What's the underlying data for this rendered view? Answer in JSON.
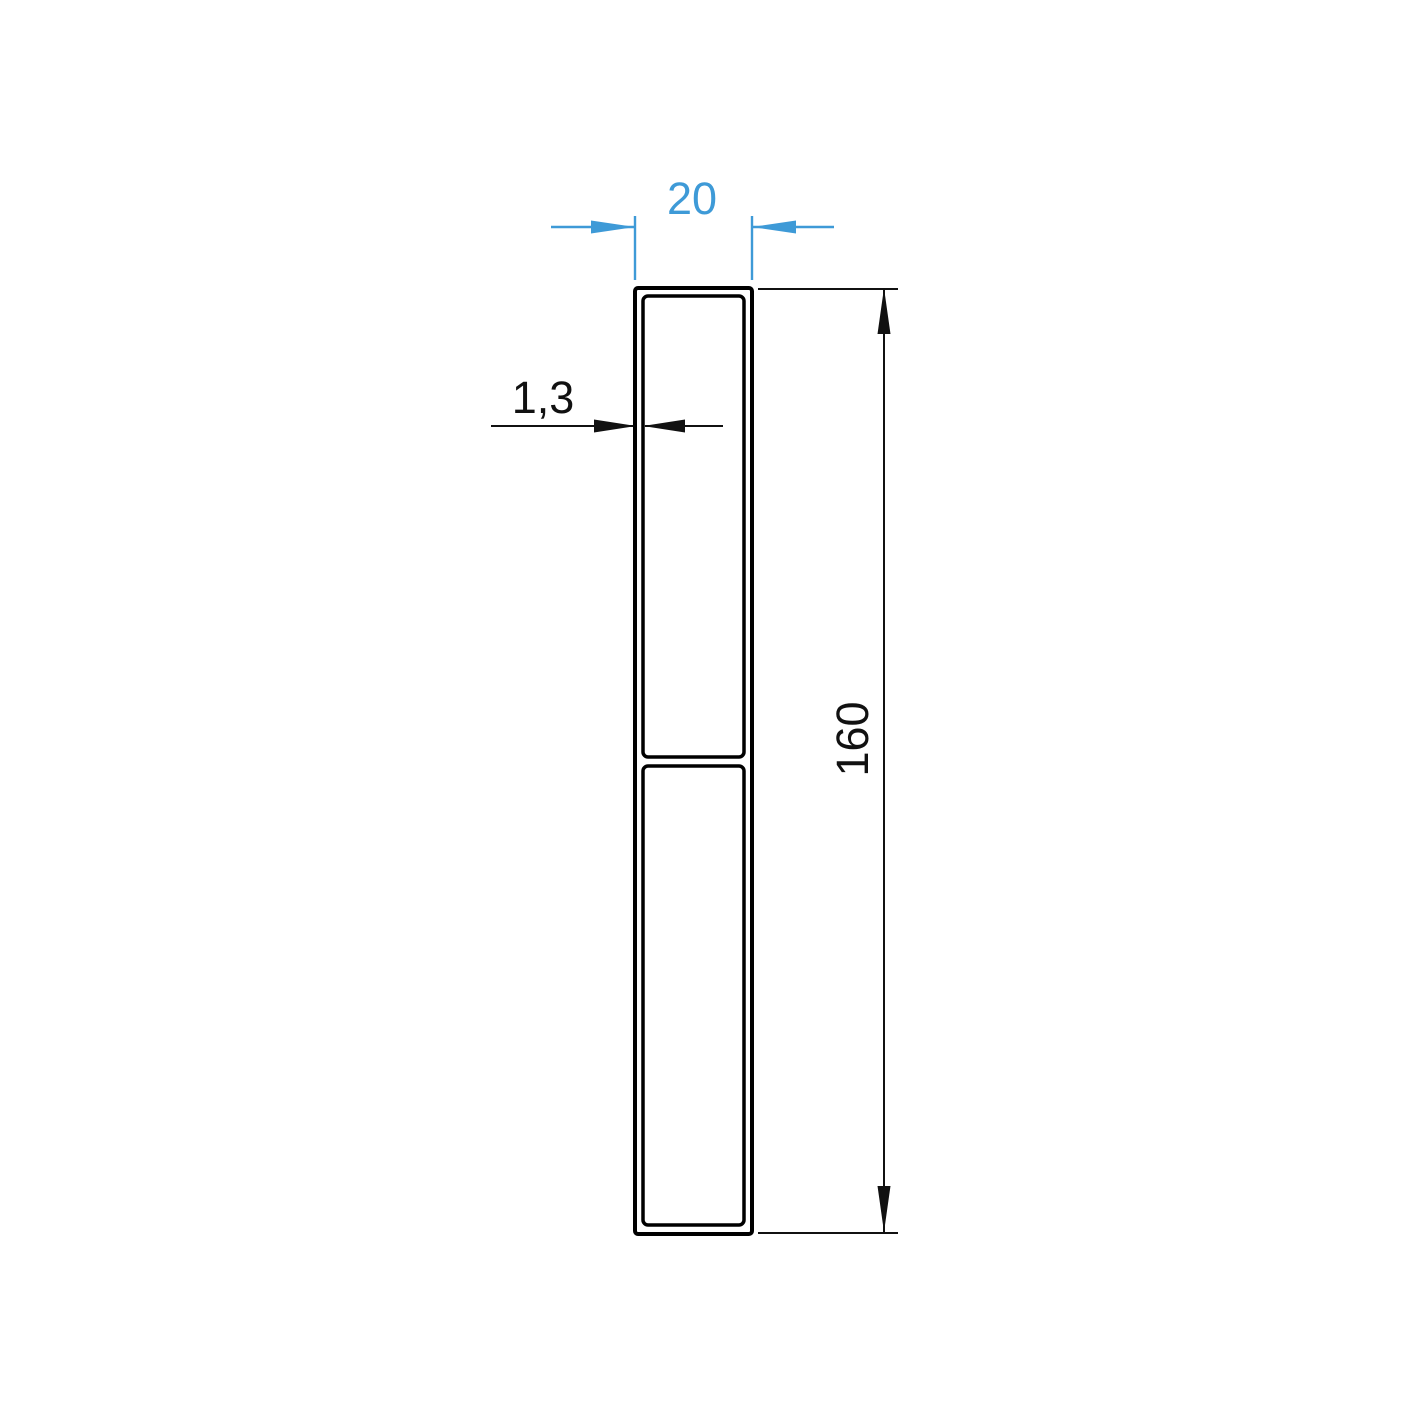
{
  "colors": {
    "background": "#ffffff",
    "profile_outline": "#000000",
    "dimension_primary": "#111111",
    "dimension_accent": "#3e9ad7"
  },
  "dimensions": {
    "width": {
      "label": "20"
    },
    "wall_thickness": {
      "label": "1,3"
    },
    "height": {
      "label": "160"
    }
  }
}
